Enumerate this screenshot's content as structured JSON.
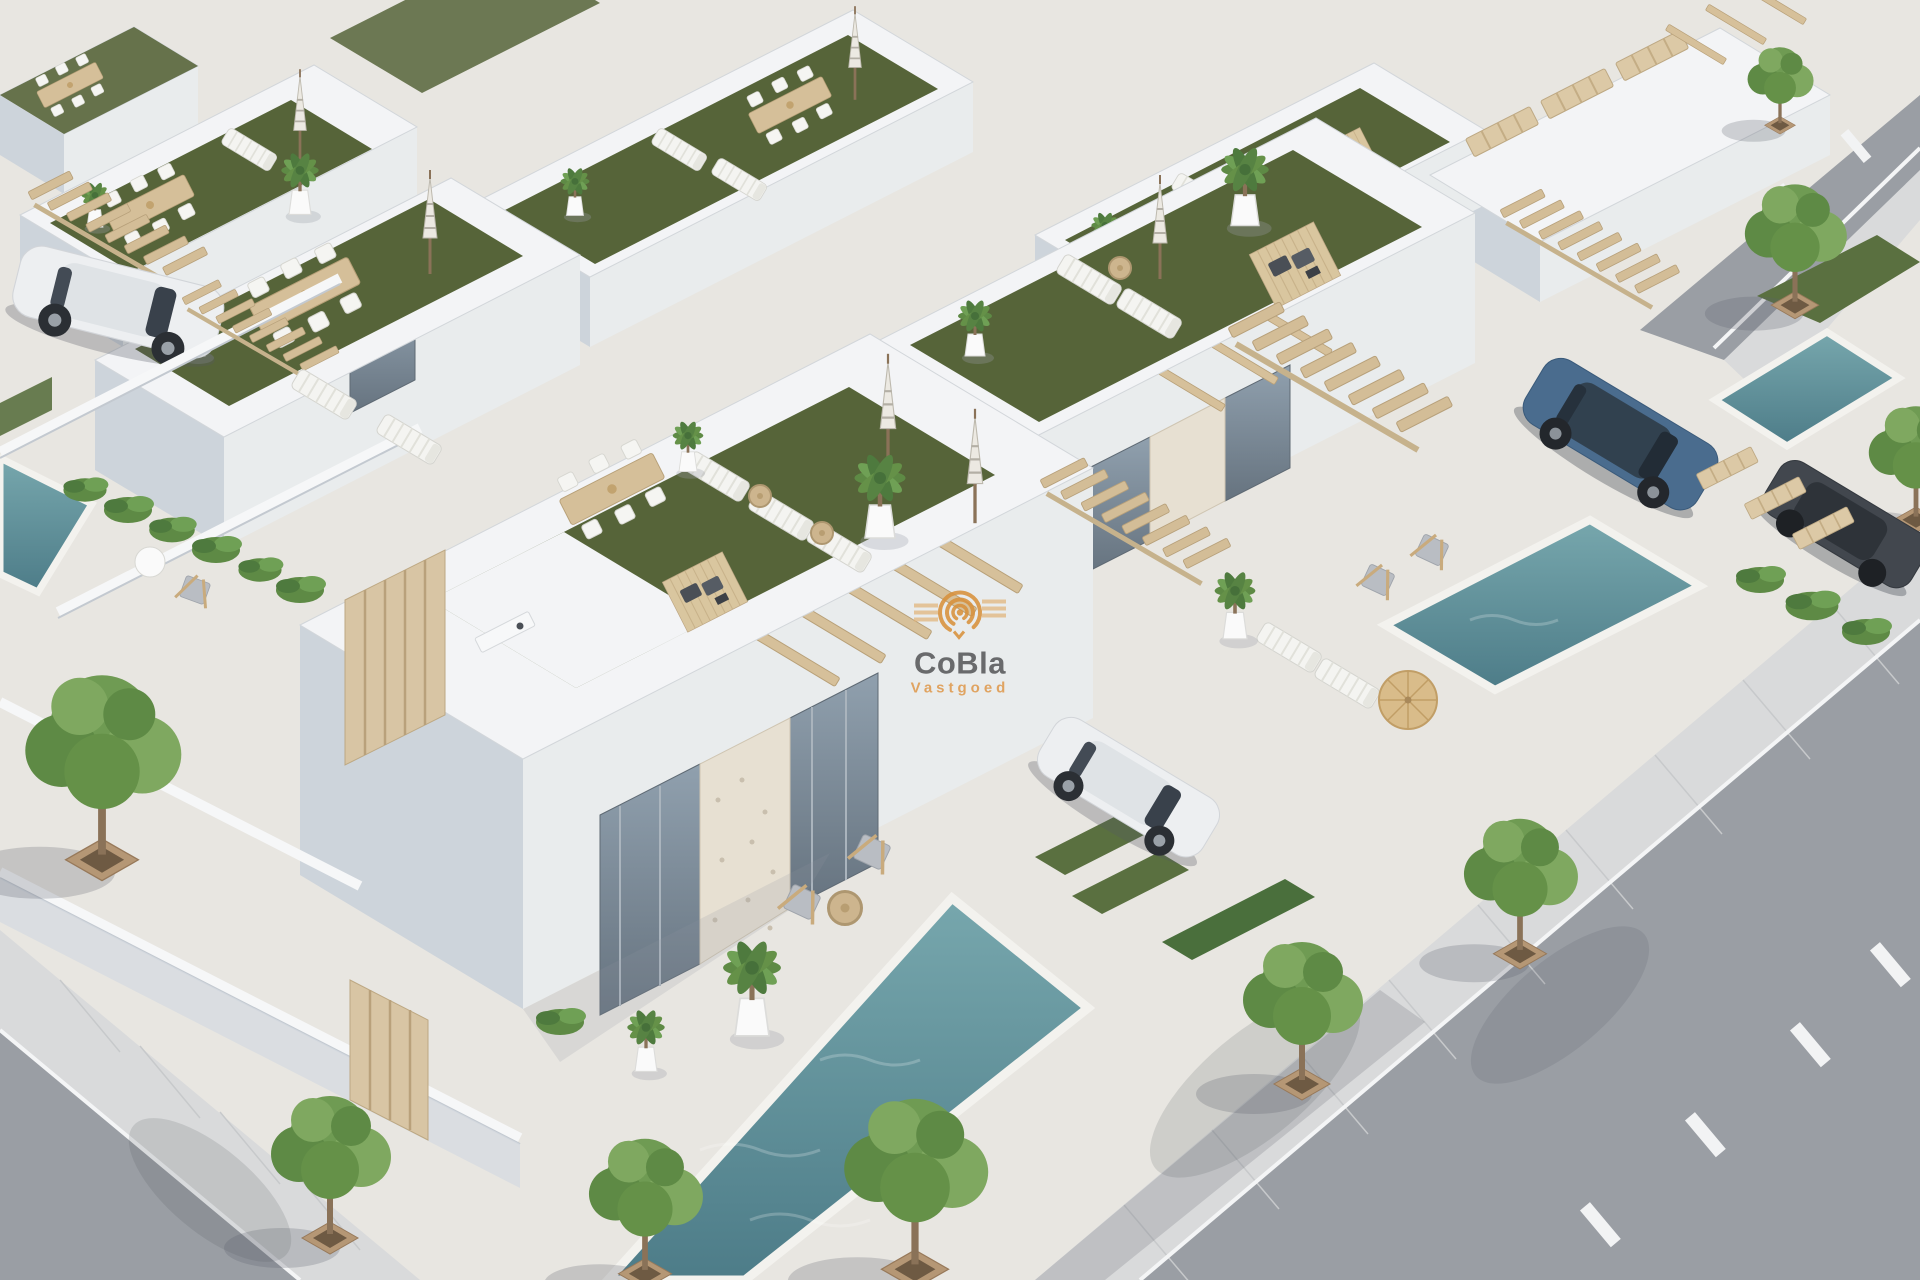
{
  "meta": {
    "domain": "natural-image",
    "description": "Aerial 3D architectural render of a modern white villa development with rooftop artificial-grass terraces, sun loungers, closed parasols, potted palms, outdoor dining sets, floating wooden stairs, private plunge pools, parked cars and tree-lined asphalt streets"
  },
  "watermark": {
    "brand": "CoBla",
    "subtitle": "Vastgoed",
    "logo": "concentric-arcs-logo"
  },
  "colors": {
    "base_paving": "#e8e6e1",
    "wall_white": "#f3f4f6",
    "wall_face_light": "#e9eced",
    "wall_face_shade": "#cdd4db",
    "roof_grass": "#566439",
    "lawn": "#5a7040",
    "hedge": "#4a6f3c",
    "pool": "#5f909b",
    "pool_deep": "#4d7c88",
    "asphalt": "#9a9ea4",
    "sidewalk": "#d9dadb",
    "road_marking": "#f2f3f4",
    "wood": "#d3bd97",
    "wood_dark": "#b7a07a",
    "tree_canopy": "#6f9b53",
    "trunk": "#8a7258",
    "planter": "#b59775",
    "glass": "#7e8e9c",
    "stone": "#e7e0d2",
    "car_white": "#eceef0",
    "suv_blue": "#4a6c8e",
    "car_graphite": "#42474e",
    "logo_orange": "#d8913c",
    "logo_tan": "#e2b377",
    "brand_text": "#58595b",
    "subtitle_text": "#df9a4e"
  },
  "scene": {
    "elements": [
      "rooftop-grass-terrace",
      "sun-lounger",
      "closed-parasol",
      "potted-palm",
      "outdoor-dining-set",
      "floating-wood-stairs",
      "plunge-pool",
      "parked-car",
      "street-tree",
      "asphalt-street",
      "pergola",
      "sunken-lounge-deck"
    ]
  }
}
